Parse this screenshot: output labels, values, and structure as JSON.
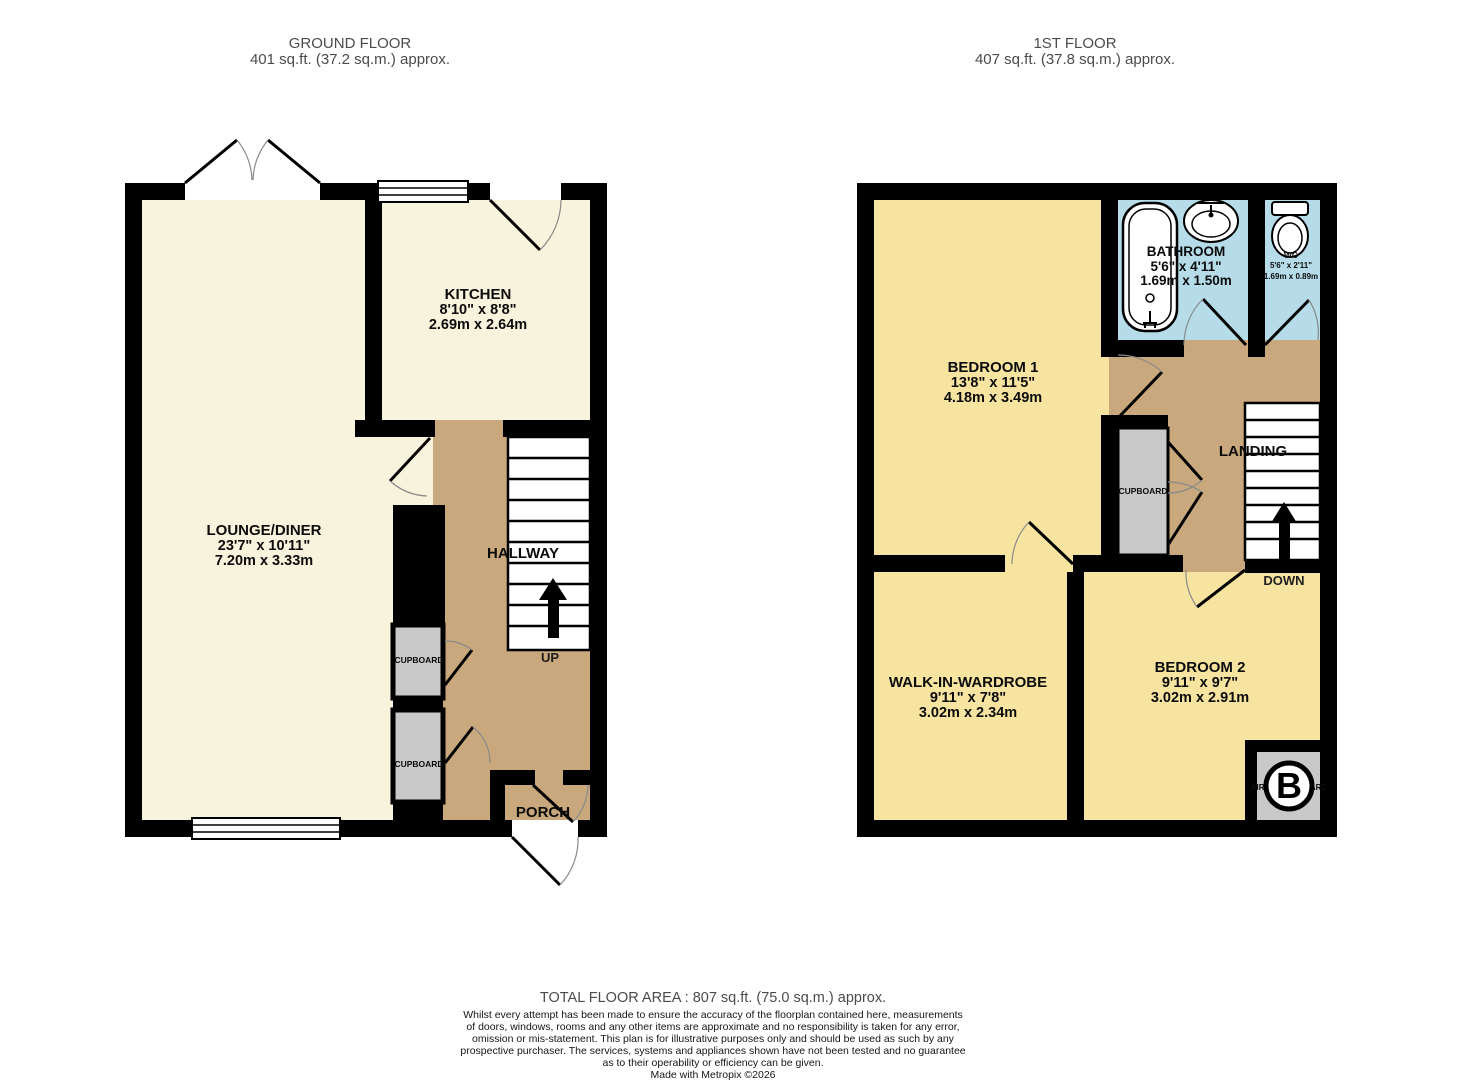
{
  "ground_floor": {
    "title": "GROUND FLOOR",
    "subtitle": "401 sq.ft. (37.2 sq.m.) approx.",
    "rooms": {
      "lounge": {
        "name": "LOUNGE/DINER",
        "imperial": "23'7\"  x 10'11\"",
        "metric": "7.20m  x 3.33m"
      },
      "kitchen": {
        "name": "KITCHEN",
        "imperial": "8'10\"  x 8'8\"",
        "metric": "2.69m  x 2.64m"
      },
      "hallway": {
        "name": "HALLWAY"
      },
      "porch": {
        "name": "PORCH"
      },
      "cupboard_upper": {
        "name": "CUPBOARD"
      },
      "cupboard_lower": {
        "name": "CUPBOARD"
      }
    },
    "stairs_label": "UP"
  },
  "first_floor": {
    "title": "1ST FLOOR",
    "subtitle": "407 sq.ft. (37.8 sq.m.) approx.",
    "rooms": {
      "bedroom1": {
        "name": "BEDROOM 1",
        "imperial": "13'8\"  x 11'5\"",
        "metric": "4.18m  x 3.49m"
      },
      "bathroom": {
        "name": "BATHROOM",
        "imperial": "5'6\"  x 4'11\"",
        "metric": "1.69m  x 1.50m"
      },
      "wc": {
        "name": "WC",
        "imperial": "5'6\"  x 2'11\"",
        "metric": "1.69m  x 0.89m"
      },
      "landing": {
        "name": "LANDING"
      },
      "bedroom2": {
        "name": "BEDROOM 2",
        "imperial": "9'11\"  x 9'7\"",
        "metric": "3.02m  x 2.91m"
      },
      "wardrobe": {
        "name": "WALK-IN-WARDROBE",
        "imperial": "9'11\"  x 7'8\"",
        "metric": "3.02m  x 2.34m"
      },
      "cupboard": {
        "name": "CUPBOARD"
      },
      "airing_cupboard": {
        "name": "AIRING CUPBOARD"
      },
      "boiler_badge": "B"
    },
    "stairs_label": "DOWN"
  },
  "footer": {
    "total_area": "TOTAL FLOOR AREA : 807 sq.ft. (75.0 sq.m.) approx.",
    "disclaimer": "Whilst every attempt has been made to ensure the accuracy of the floorplan contained here, measurements\nof doors, windows, rooms and any other items are approximate and no responsibility is taken for any error,\nomission or mis-statement. This plan is for illustrative purposes only and should be used as such by any\nprospective purchaser. The services, systems and appliances shown have not been tested and no guarantee\nas to their operability or efficiency can be given.",
    "credit": "Made with Metropix ©2026"
  },
  "colors": {
    "room_cream": "#f8f3dc",
    "room_yellow": "#f7e4a0",
    "circulation_tan": "#c8a87c",
    "wet_room_blue": "#b5dce8",
    "cupboard_grey": "#c9c9c9",
    "wall_black": "#000000",
    "title_grey": "#4b4b4b"
  }
}
